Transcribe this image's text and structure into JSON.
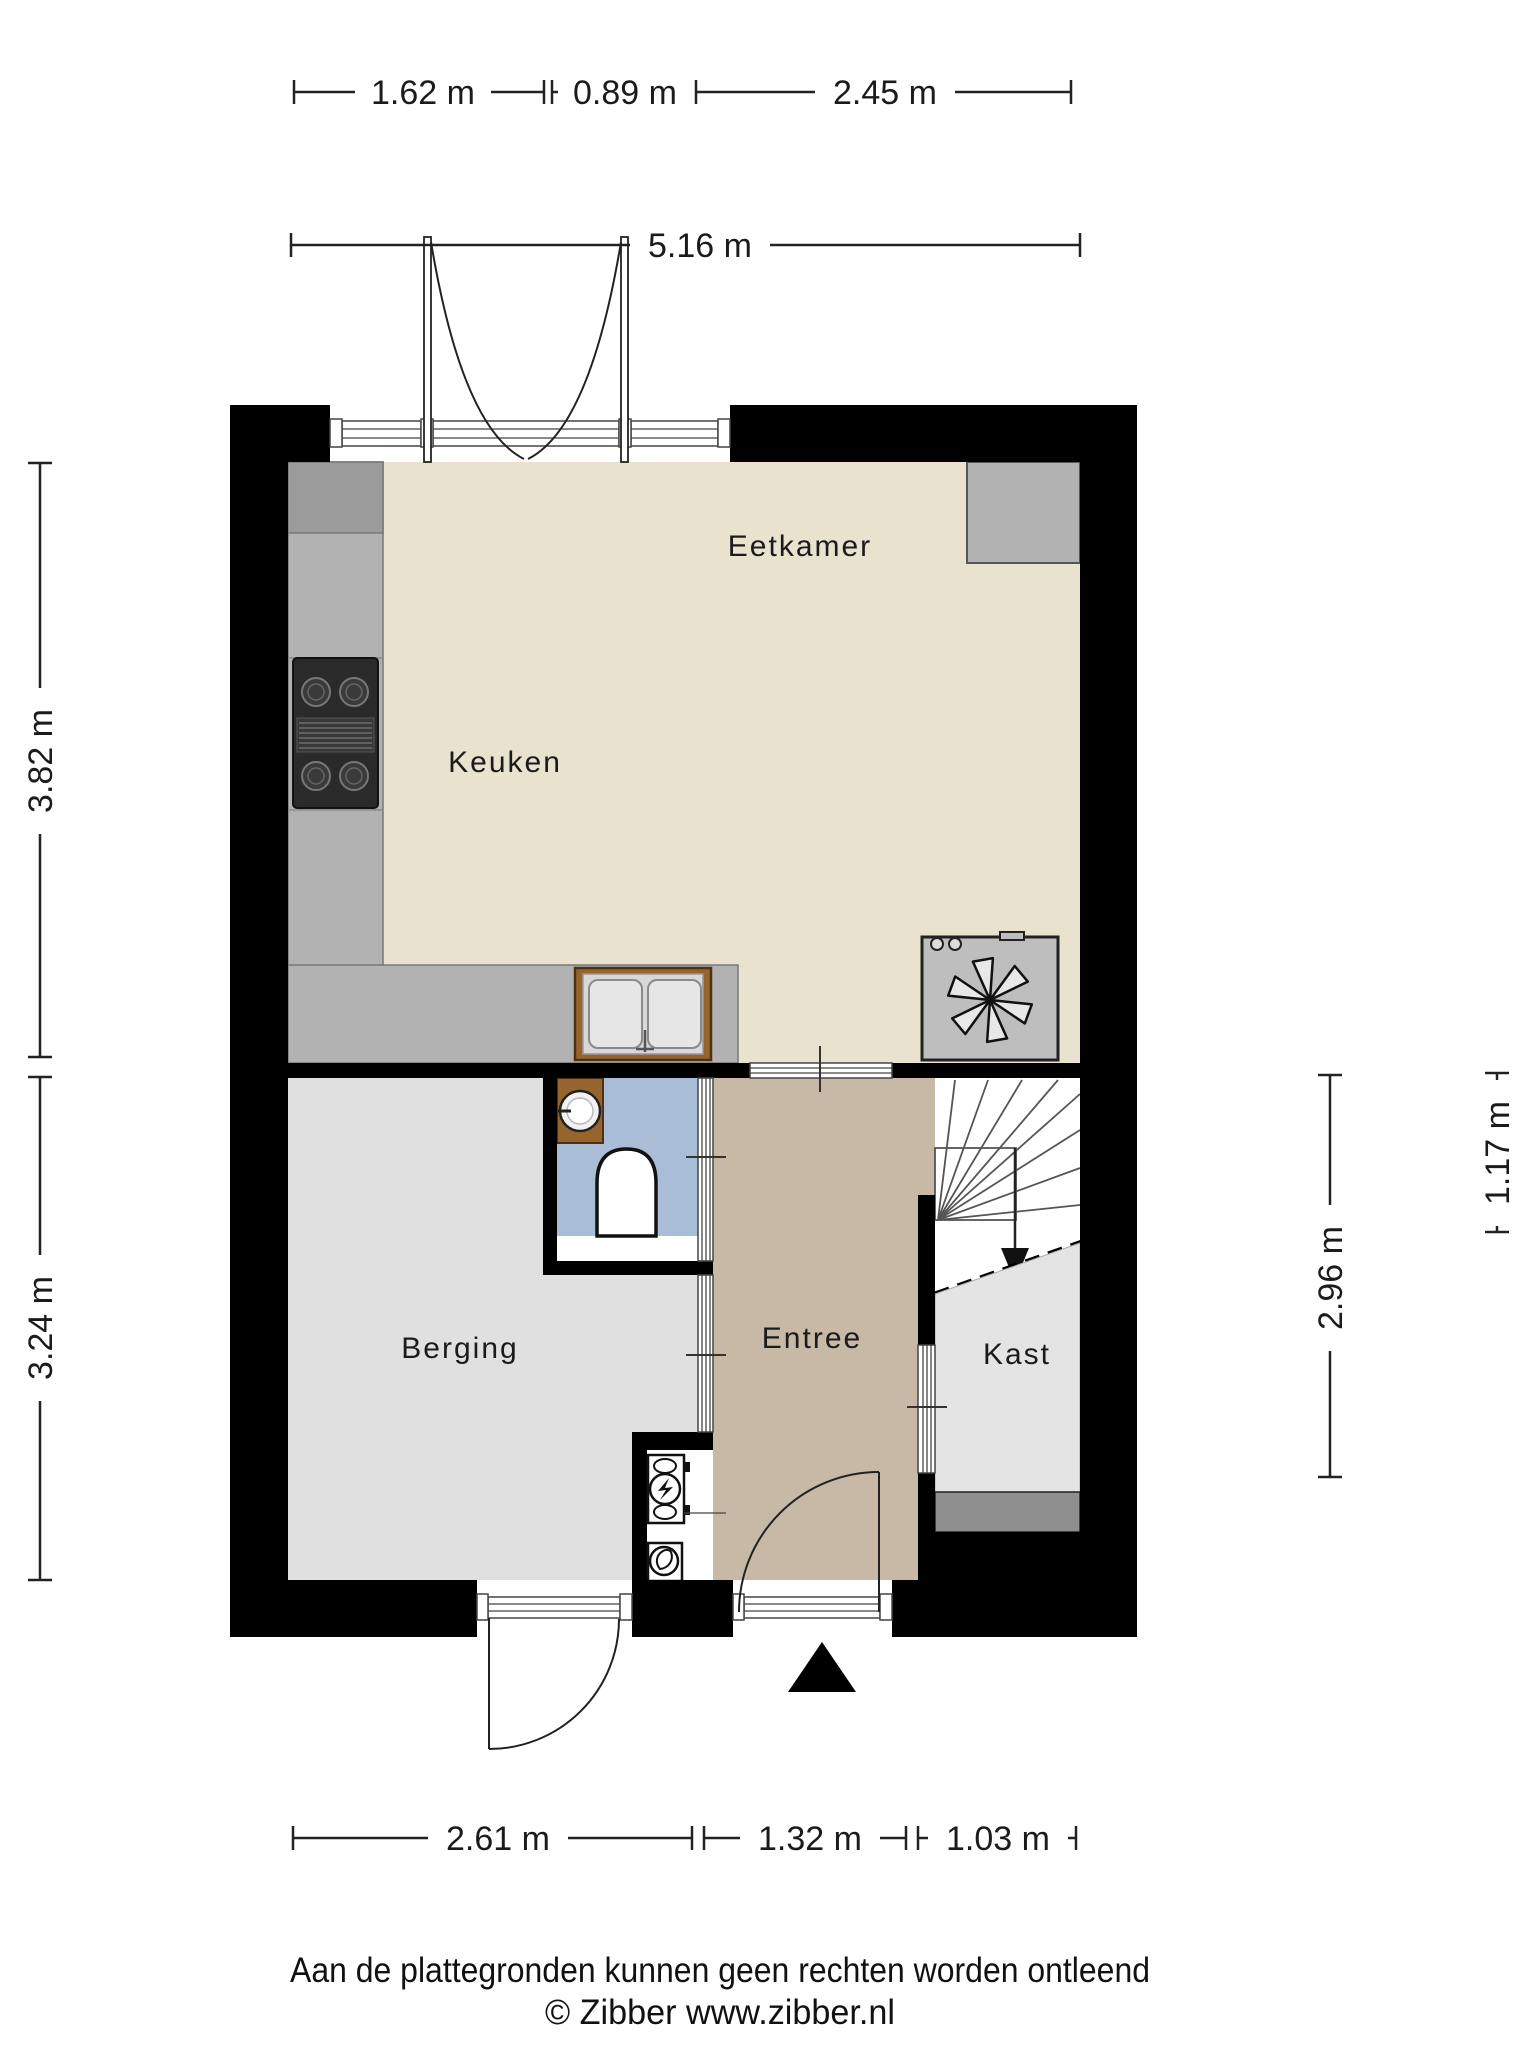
{
  "title": "Begane grond plattegrond",
  "rooms": {
    "keuken": {
      "label": "Keuken"
    },
    "eetkamer": {
      "label": "Eetkamer"
    },
    "berging": {
      "label": "Berging"
    },
    "entree": {
      "label": "Entree"
    },
    "kast": {
      "label": "Kast"
    }
  },
  "dimensions": {
    "top": [
      {
        "label": "1.62 m"
      },
      {
        "label": "0.89 m"
      },
      {
        "label": "2.45 m"
      }
    ],
    "top_total": {
      "label": "5.16 m"
    },
    "left": [
      {
        "label": "3.82 m"
      },
      {
        "label": "3.24 m"
      }
    ],
    "right": [
      {
        "label": "2.96 m"
      },
      {
        "label": "1.17 m"
      }
    ],
    "bottom": [
      {
        "label": "2.61 m"
      },
      {
        "label": "1.32 m"
      },
      {
        "label": "1.03 m"
      }
    ]
  },
  "fixtures": {
    "stove": "cooktop-icon",
    "sink": "kitchen-sink-icon",
    "mechanical_unit": "fan-icon",
    "washbasin": "washbasin-icon",
    "toilet": "toilet-icon",
    "electric_meter": "electric-meter-icon",
    "gas_meter": "gas-meter-icon",
    "stairs": "winder-stairs",
    "stairs_direction": "down-arrow-icon",
    "entrance": "entrance-arrow-icon"
  },
  "palette": {
    "wall": "#000000",
    "floor_living": "#E9E2CE",
    "floor_storage": "#E0E0E0",
    "floor_hall": "#C8B9A6",
    "floor_toilet": "#A9BDD6",
    "floor_closet": "#E4E4E4",
    "closet_strip": "#8F8F8F",
    "counter": "#B2B2B2",
    "counter_dark": "#9B9B9B",
    "wood": "#96652D",
    "appliance": "#BEBEBE",
    "text": "#1B1B1B"
  },
  "footer": {
    "line1": "Aan de plattegronden kunnen geen rechten worden ontleend",
    "line2": "© Zibber www.zibber.nl"
  }
}
